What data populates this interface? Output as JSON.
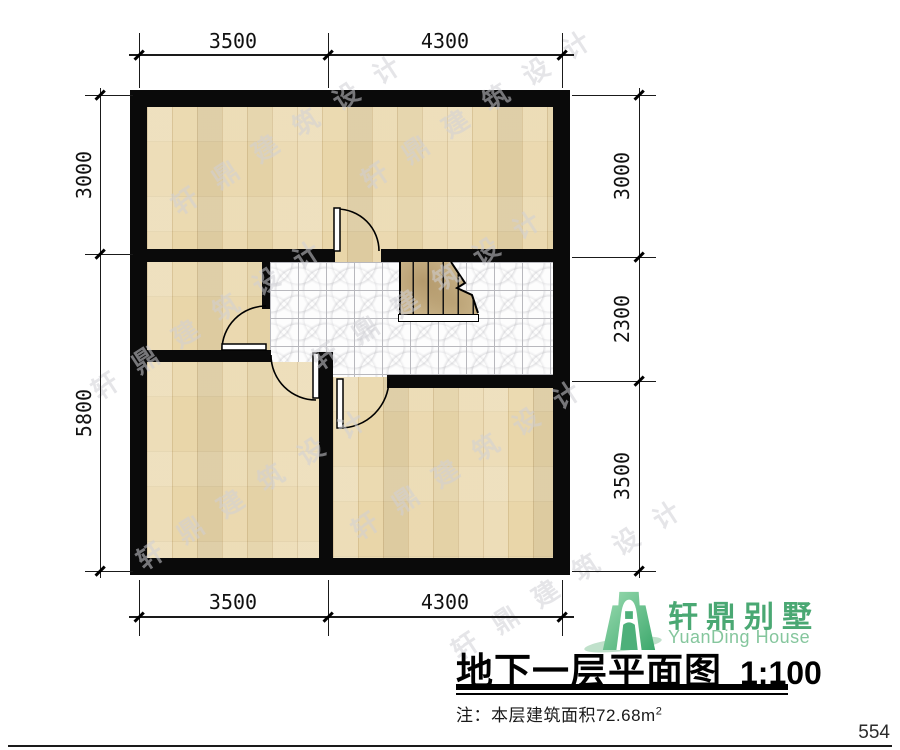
{
  "title": {
    "text": "地下一层平面图",
    "scale": "1:100"
  },
  "note": {
    "prefix": "注：本层建筑面积",
    "value": "72.68",
    "unit": "m",
    "sup": "2"
  },
  "logo": {
    "name": "轩鼎别墅",
    "subtitle": "YuanDing House"
  },
  "page_number": "554",
  "watermark": {
    "text": "轩鼎建筑设计"
  },
  "dims": {
    "top": [
      "3500",
      "4300"
    ],
    "bottom": [
      "3500",
      "4300"
    ],
    "left": [
      "3000",
      "5800"
    ],
    "right": [
      "3000",
      "2300",
      "3500"
    ]
  },
  "colors": {
    "wall": "#0a0a0a",
    "wood_floor": "#e9d6a9",
    "tile_floor": "#fdfdfd",
    "stair_tread": "#cfba90",
    "brand_green": "#4aa873",
    "brand_light_green": "#85c69d"
  },
  "drawing": {
    "type": "basement-floor-plan",
    "rooms": [
      "top-room",
      "middle-left-room",
      "bottom-left-room",
      "bottom-right-room",
      "stair-hall"
    ]
  }
}
